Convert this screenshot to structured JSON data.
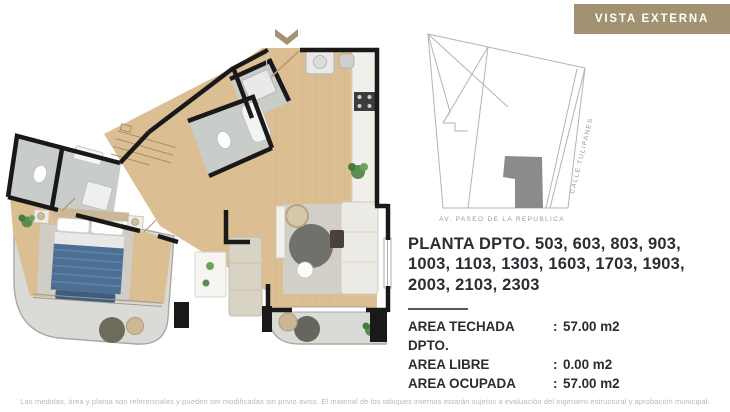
{
  "badge": {
    "label": "VISTA EXTERNA"
  },
  "sitemap": {
    "street_bottom_label": "AV. PASEO DE LA REPUBLICA",
    "street_right_label": "CALLE TULIPANES"
  },
  "info": {
    "title": "PLANTA DPTO. 503, 603, 803, 903, 1003, 1103, 1303, 1603, 1703, 1903, 2003, 2103, 2303",
    "colon": ":",
    "areas": [
      {
        "label": "AREA TECHADA DPTO.",
        "value": "57.00 m2"
      },
      {
        "label": "AREA LIBRE",
        "value": "0.00 m2"
      },
      {
        "label": "AREA OCUPADA",
        "value": "57.00 m2"
      }
    ]
  },
  "disclaimer": "Las medidas, área y planta son referenciales y pueden ser modificadas sin privio aviso. El material de los tabiques internos estarán sujetos a evaluación del ingeniero estructural y aprobación municipal.",
  "colors": {
    "accent_gold": "#a39272",
    "wall": "#191919",
    "wood_floor": "#dcbe93",
    "bath_tile": "#c9cdca",
    "rug": "#d0cdc7",
    "concrete": "#dadad6",
    "bed_blue": "#4b6e92",
    "map_line": "#b3b3b3",
    "map_building": "#8b8b8b",
    "text_dark": "#2c2c33",
    "text_muted": "#b9b9b9"
  }
}
